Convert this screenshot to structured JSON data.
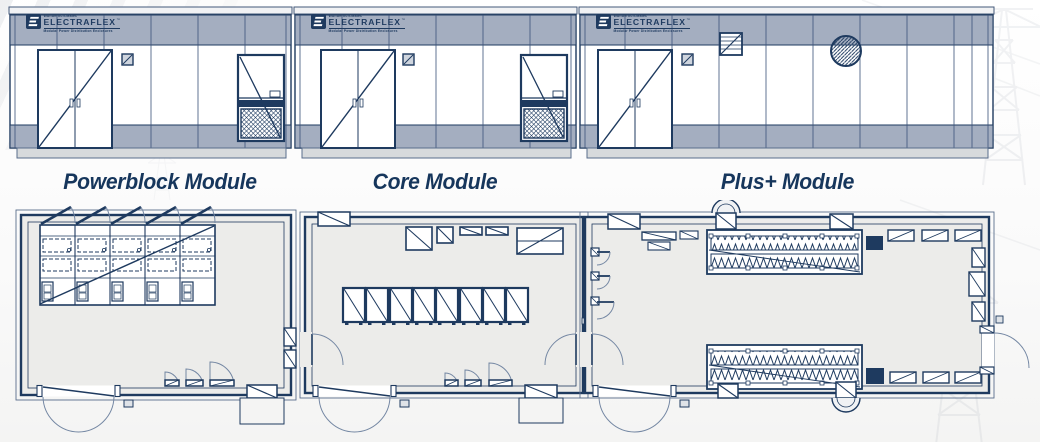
{
  "logo": {
    "maker_line": "Wunderlich-Malec",
    "brand": "ELECTRAFLEX",
    "trademark": "™",
    "tagline": "Modular Power Distribution Enclosures"
  },
  "modules": [
    {
      "id": "powerblock",
      "title": "Powerblock Module"
    },
    {
      "id": "core",
      "title": "Core Module"
    },
    {
      "id": "plus",
      "title": "Plus+ Module"
    }
  ],
  "colors": {
    "line_navy": "#1e3a5f",
    "band_gray_blue": "#a4aec0",
    "floor_fill": "#ececea",
    "skid_gray": "#d7dadc",
    "title_navy": "#16365c",
    "background": "#fafafa",
    "watermark_gray": "#9aa3ad"
  }
}
